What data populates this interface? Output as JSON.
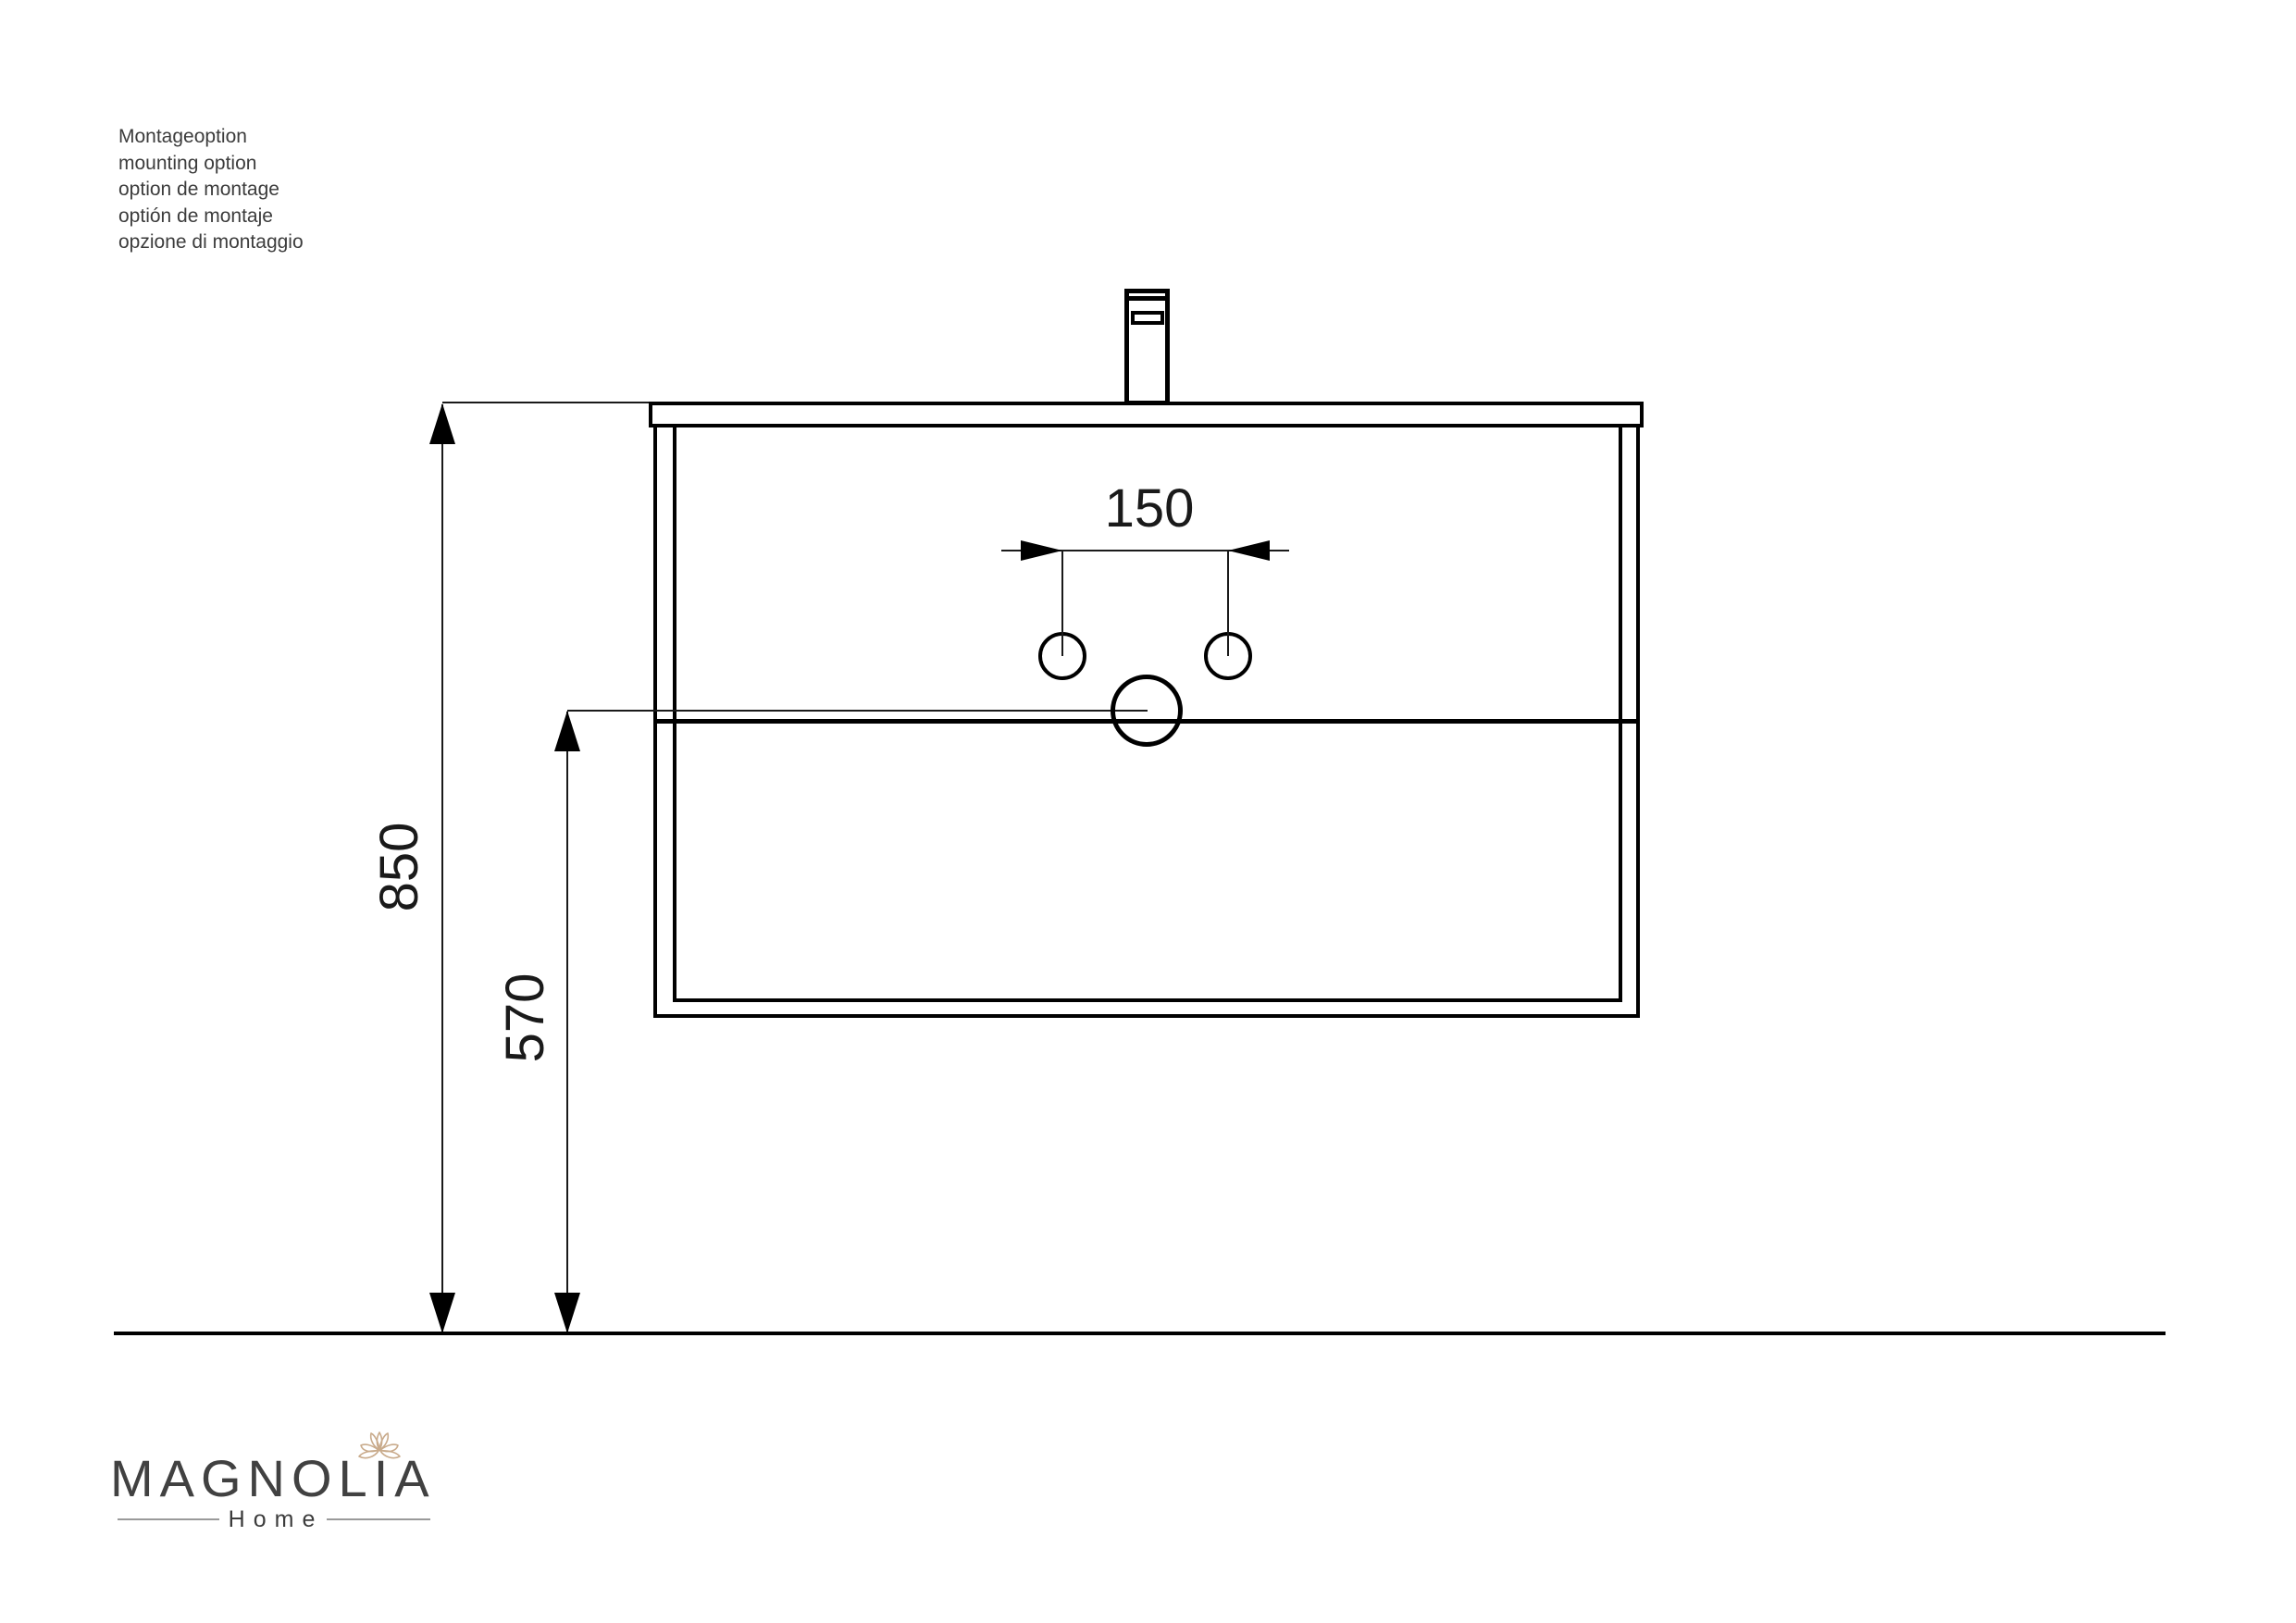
{
  "notes": {
    "lines": [
      "Montageoption",
      "mounting option",
      "option de montage",
      "optión de montaje",
      "opzione di montaggio"
    ]
  },
  "dimensions": {
    "faucet_hole_spacing_mm": "150",
    "worktop_height_mm": "850",
    "drain_height_mm": "570"
  },
  "logo": {
    "brand": "MAGNOLIA",
    "tagline": "Home"
  },
  "colors": {
    "line": "#000000",
    "note_text": "#3c3c3c",
    "logo_text": "#414141",
    "flower": "#c9ab8c",
    "background": "#ffffff"
  }
}
